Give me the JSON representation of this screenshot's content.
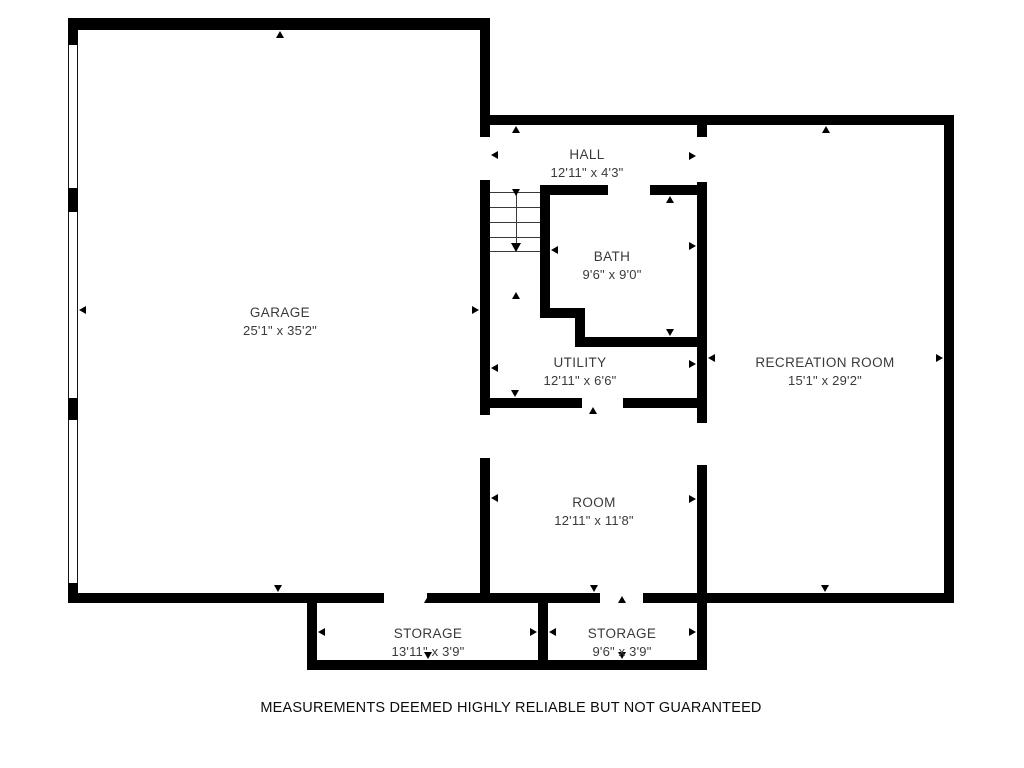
{
  "disclaimer": "MEASUREMENTS DEEMED HIGHLY RELIABLE BUT NOT GUARANTEED",
  "floorplan": {
    "canvas": {
      "width": 1024,
      "height": 768,
      "background": "#ffffff",
      "wall_color": "#000000",
      "label_color": "#3a3a3a"
    },
    "rooms": [
      {
        "id": "garage",
        "name": "GARAGE",
        "dimensions": "25'1\" x 35'2\"",
        "label_cx": 280,
        "label_top": 304
      },
      {
        "id": "hall",
        "name": "HALL",
        "dimensions": "12'11\" x 4'3\"",
        "label_cx": 587,
        "label_top": 146
      },
      {
        "id": "bath",
        "name": "BATH",
        "dimensions": "9'6\" x 9'0\"",
        "label_cx": 612,
        "label_top": 248
      },
      {
        "id": "utility",
        "name": "UTILITY",
        "dimensions": "12'11\" x 6'6\"",
        "label_cx": 580,
        "label_top": 354
      },
      {
        "id": "recreation-room",
        "name": "RECREATION ROOM",
        "dimensions": "15'1\" x 29'2\"",
        "label_cx": 825,
        "label_top": 354
      },
      {
        "id": "room",
        "name": "ROOM",
        "dimensions": "12'11\" x 11'8\"",
        "label_cx": 594,
        "label_top": 494
      },
      {
        "id": "storage-1",
        "name": "STORAGE",
        "dimensions": "13'11\" x 3'9\"",
        "label_cx": 428,
        "label_top": 625
      },
      {
        "id": "storage-2",
        "name": "STORAGE",
        "dimensions": "9'6\" x 3'9\"",
        "label_cx": 622,
        "label_top": 625
      }
    ],
    "walls": [
      [
        68,
        18,
        422,
        12
      ],
      [
        68,
        18,
        10,
        27
      ],
      [
        68,
        188,
        10,
        24
      ],
      [
        68,
        398,
        10,
        22
      ],
      [
        68,
        583,
        10,
        20
      ],
      [
        480,
        18,
        10,
        119
      ],
      [
        480,
        180,
        10,
        235
      ],
      [
        480,
        458,
        10,
        135
      ],
      [
        490,
        115,
        464,
        10
      ],
      [
        944,
        115,
        10,
        488
      ],
      [
        68,
        593,
        316,
        10
      ],
      [
        427,
        593,
        173,
        10
      ],
      [
        643,
        593,
        311,
        10
      ],
      [
        697,
        125,
        10,
        12
      ],
      [
        697,
        182,
        10,
        241
      ],
      [
        697,
        465,
        10,
        138
      ],
      [
        540,
        185,
        68,
        10
      ],
      [
        650,
        185,
        57,
        10
      ],
      [
        540,
        185,
        10,
        133
      ],
      [
        540,
        308,
        45,
        10
      ],
      [
        575,
        308,
        10,
        39
      ],
      [
        575,
        337,
        132,
        10
      ],
      [
        480,
        398,
        102,
        10
      ],
      [
        623,
        398,
        84,
        10
      ],
      [
        307,
        593,
        10,
        77
      ],
      [
        307,
        660,
        400,
        10
      ],
      [
        538,
        593,
        10,
        77
      ],
      [
        697,
        593,
        10,
        77
      ]
    ],
    "window_openings": [
      [
        68,
        45,
        10,
        143
      ],
      [
        68,
        212,
        10,
        186
      ],
      [
        68,
        420,
        10,
        163
      ]
    ],
    "stairs": {
      "tread_x1": 490,
      "tread_x2": 540,
      "tread_ys": [
        192,
        207,
        222,
        237,
        251
      ],
      "center_line": {
        "x": 516,
        "y1": 192,
        "y2": 244
      },
      "direction_arrow_tip": [
        516,
        252
      ]
    },
    "dimension_arrows": [
      {
        "room": "garage",
        "dir": "up",
        "tip": [
          280,
          31
        ]
      },
      {
        "room": "garage",
        "dir": "down",
        "tip": [
          278,
          592
        ]
      },
      {
        "room": "garage",
        "dir": "left",
        "tip": [
          79,
          310
        ]
      },
      {
        "room": "garage",
        "dir": "right",
        "tip": [
          479,
          310
        ]
      },
      {
        "room": "hall",
        "dir": "up",
        "tip": [
          516,
          126
        ]
      },
      {
        "room": "hall",
        "dir": "down",
        "tip": [
          516,
          196
        ]
      },
      {
        "room": "hall",
        "dir": "left",
        "tip": [
          491,
          155
        ]
      },
      {
        "room": "hall",
        "dir": "right",
        "tip": [
          696,
          156
        ]
      },
      {
        "room": "bath",
        "dir": "up",
        "tip": [
          670,
          196
        ]
      },
      {
        "room": "bath",
        "dir": "down",
        "tip": [
          670,
          336
        ]
      },
      {
        "room": "bath",
        "dir": "left",
        "tip": [
          551,
          250
        ]
      },
      {
        "room": "bath",
        "dir": "right",
        "tip": [
          696,
          246
        ]
      },
      {
        "room": "utility",
        "dir": "up",
        "tip": [
          516,
          292
        ]
      },
      {
        "room": "utility",
        "dir": "down",
        "tip": [
          515,
          397
        ]
      },
      {
        "room": "utility",
        "dir": "left",
        "tip": [
          491,
          368
        ]
      },
      {
        "room": "utility",
        "dir": "right",
        "tip": [
          696,
          364
        ]
      },
      {
        "room": "room",
        "dir": "up",
        "tip": [
          593,
          407
        ]
      },
      {
        "room": "room",
        "dir": "down",
        "tip": [
          594,
          592
        ]
      },
      {
        "room": "room",
        "dir": "left",
        "tip": [
          491,
          498
        ]
      },
      {
        "room": "room",
        "dir": "right",
        "tip": [
          696,
          499
        ]
      },
      {
        "room": "recreation-room",
        "dir": "up",
        "tip": [
          826,
          126
        ]
      },
      {
        "room": "recreation-room",
        "dir": "down",
        "tip": [
          825,
          592
        ]
      },
      {
        "room": "recreation-room",
        "dir": "left",
        "tip": [
          708,
          358
        ]
      },
      {
        "room": "recreation-room",
        "dir": "right",
        "tip": [
          943,
          358
        ]
      },
      {
        "room": "storage-1",
        "dir": "up",
        "tip": [
          428,
          596
        ]
      },
      {
        "room": "storage-1",
        "dir": "down",
        "tip": [
          428,
          659
        ]
      },
      {
        "room": "storage-1",
        "dir": "left",
        "tip": [
          318,
          632
        ]
      },
      {
        "room": "storage-1",
        "dir": "right",
        "tip": [
          537,
          632
        ]
      },
      {
        "room": "storage-2",
        "dir": "up",
        "tip": [
          622,
          596
        ]
      },
      {
        "room": "storage-2",
        "dir": "down",
        "tip": [
          622,
          659
        ]
      },
      {
        "room": "storage-2",
        "dir": "left",
        "tip": [
          549,
          632
        ]
      },
      {
        "room": "storage-2",
        "dir": "right",
        "tip": [
          696,
          632
        ]
      }
    ]
  }
}
